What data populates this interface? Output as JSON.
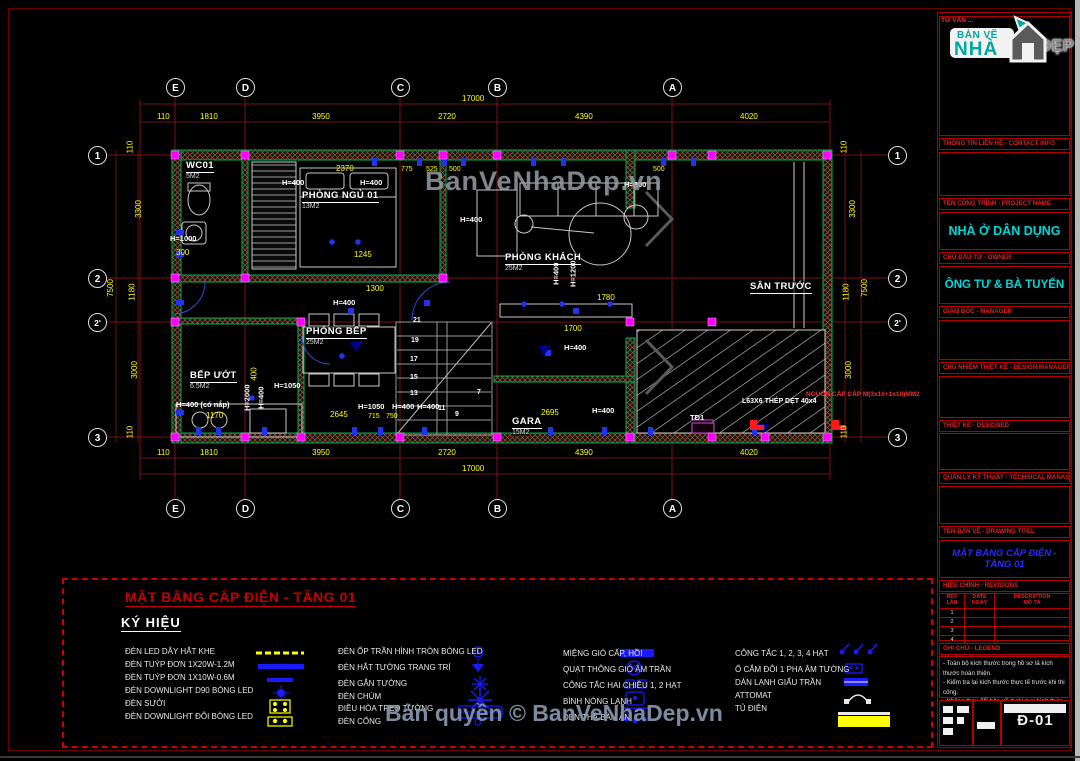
{
  "sheet": {
    "code": "Đ-01",
    "watermark_center": "BanVeNhaDep.vn",
    "watermark_bottom": "Bản quyền © BanVeNhaDep.vn"
  },
  "logo": {
    "top": "BẢN VẼ",
    "name": "NHÀ",
    "dep": "ĐẸP"
  },
  "grid": {
    "cols": [
      "E",
      "D",
      "C",
      "B",
      "A"
    ],
    "rows": [
      "1",
      "2",
      "2'",
      "3"
    ]
  },
  "dims": {
    "total": "17000",
    "top": [
      "110",
      "1810",
      "3950",
      "2720",
      "4390",
      "4020"
    ],
    "bottom": [
      "110",
      "1810",
      "3950",
      "2720",
      "4390",
      "4020"
    ],
    "side_total": "7500",
    "side": [
      "110",
      "3300",
      "1180",
      "3000",
      "110"
    ]
  },
  "rooms": [
    {
      "name": "WC01",
      "area": "5M2"
    },
    {
      "name": "PHÒNG NGỦ 01",
      "area": "13M2"
    },
    {
      "name": "PHÒNG KHÁCH",
      "area": "25M2"
    },
    {
      "name": "PHÒNG BẾP",
      "area": "25M2"
    },
    {
      "name": "BẾP ƯỚT",
      "area": "6.5M2"
    },
    {
      "name": "GARA",
      "area": "15M2"
    },
    {
      "name": "SÂN TRƯỚC",
      "area": ""
    }
  ],
  "plan": {
    "labels": [
      "H=1000",
      "300",
      "2370",
      "H=400",
      "H=400",
      "775",
      "525",
      "500",
      "500",
      "H=800",
      "H=400",
      "H=400",
      "H=1200",
      "1780",
      "1245",
      "1300",
      "H=400",
      "1700",
      "H=400",
      "H=1050",
      "400",
      "H=2000",
      "H=400",
      "H=400 (có nắp)",
      "1170",
      "2645",
      "H=1050",
      "H=400",
      "H=400",
      "715",
      "750",
      "2695",
      "H=400"
    ],
    "stairs": [
      "21",
      "19",
      "17",
      "15",
      "13",
      "11",
      "9",
      "7"
    ],
    "panel": "TĐ1",
    "steel_note": "L63X6 THÉP DẸT 40x4",
    "power_note": "NGUỒN CẤP CÁP M(3x16+1x10)MM2"
  },
  "legend": {
    "title": "MẶT BẰNG CẤP ĐIỆN - TẦNG 01",
    "subtitle": "KÝ HIỆU",
    "col1": [
      "ĐÈN LED DÂY HẮT KHE",
      "ĐÈN TUÝP ĐƠN 1X20W-1.2M",
      "ĐÈN TUÝP ĐƠN 1X10W-0.6M",
      "ĐÈN DOWNLIGHT D90 BÓNG LED",
      "ĐÈN SƯỞI",
      "ĐÈN DOWNLIGHT ĐÔI BÓNG LED"
    ],
    "col2": [
      "ĐÈN ỐP TRẦN HÌNH TRÒN BÓNG LED",
      "ĐÈN HẮT TƯỜNG TRANG TRÍ",
      "ĐÈN GẮN TƯỜNG",
      "ĐÈN CHÙM",
      "ĐIỀU HÒA TREO TƯỜNG",
      "ĐÈN CỔNG"
    ],
    "col3": [
      "MIỆNG GIÓ CẤP, HỒI",
      "QUẠT THÔNG GIÓ ÂM TRẦN",
      "CÔNG TẮC HAI CHIỀU 1, 2 HẠT",
      "BÌNH NÓNG LẠNH",
      "ĐÈN THẢ BÀN ĂN"
    ],
    "col4": [
      "CÔNG TẮC 1, 2, 3, 4 HẠT",
      "Ổ CẮM ĐÔI 1 PHA ÂM TƯỜNG",
      "DÀN LẠNH GIẤU TRẦN",
      "ATTOMAT",
      "TỦ ĐIỆN"
    ]
  },
  "titleblock": {
    "consult": "TƯ VẤN ...",
    "contact_label": "THÔNG TIN LIÊN HỆ - CONTACT INFO",
    "project_label": "TÊN CÔNG TRÌNH - PROJECT NAME",
    "project": "NHÀ Ở DÂN DỤNG",
    "owner_label": "CHỦ ĐẦU TƯ - OWNER",
    "owner": "ÔNG TƯ & BÀ TUYẾN",
    "manager_label": "GIÁM ĐỐC - MANAGER",
    "design_manager_label": "CHỦ NHIỆM THIẾT KẾ - DESIGN MANAGER",
    "designed_label": "THIẾT KẾ - DESIGNED",
    "tech_label": "QUẢN LÝ KỸ THUẬT - TECHNICAL MANAGER",
    "drawing_label": "TÊN BẢN VẼ - DRAWING TITEL",
    "drawing_title": "MẶT BẰNG CẤP ĐIỆN - TẦNG 01",
    "rev_label": "HIỆU CHỈNH - REVISIONS",
    "rev_headers": {
      "c1a": "REV",
      "c1b": "LẦN",
      "c2a": "DATE",
      "c2b": "NGÀY",
      "c3a": "DESCRIPTION",
      "c3b": "MÔ TẢ"
    },
    "rev_rows": [
      "1",
      "2",
      "3",
      "4"
    ],
    "notes_label": "GHI CHÚ - LEGEND",
    "notes": [
      "- Toàn bộ kích thước trong hồ sơ là kích thước hoàn thiện.",
      "- Kiểm tra lại kích thước thực tế trước khi thi công.",
      "- Không thay đổi bản vẽ dưới mọi hình thức nếu không có sự chấp thuận của đơn vị thiết kế."
    ]
  }
}
